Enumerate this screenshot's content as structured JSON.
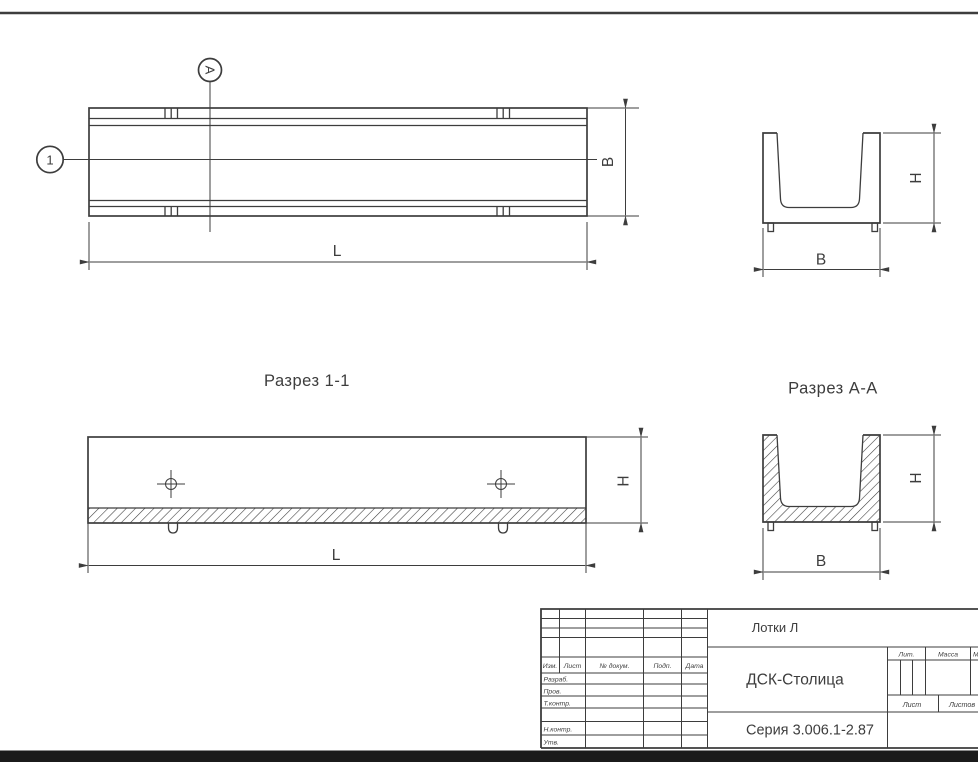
{
  "colors": {
    "line": "#3d3d3d",
    "bottom_bar": "#1b1b1b"
  },
  "plan_view": {
    "balloon": "1",
    "section_letter": "А",
    "dim_width": "B",
    "dim_length": "L"
  },
  "end_view": {
    "dim_height": "H",
    "dim_width": "B"
  },
  "section_1_1": {
    "title": "Разрез 1-1",
    "dim_height": "H",
    "dim_length": "L"
  },
  "section_a_a": {
    "title": "Разрез А-А",
    "dim_height": "H",
    "dim_width": "B"
  },
  "title_block": {
    "product": "Лотки Л",
    "organization": "ДСК-Столица",
    "series": "Серия 3.006.1-2.87",
    "cols": {
      "izm": "Изм.",
      "list": "Лист",
      "doc": "№ докум.",
      "sign": "Подп.",
      "date": "Дата"
    },
    "rows": {
      "developed": "Разраб.",
      "checked": "Пров.",
      "tcontrol": "Т.контр.",
      "ncontrol": "Н.контр.",
      "approved": "Утв."
    },
    "props": {
      "lit": "Лит.",
      "mass": "Масса",
      "scale": "Масштаб",
      "sheet": "Лист",
      "sheets": "Листов"
    }
  }
}
